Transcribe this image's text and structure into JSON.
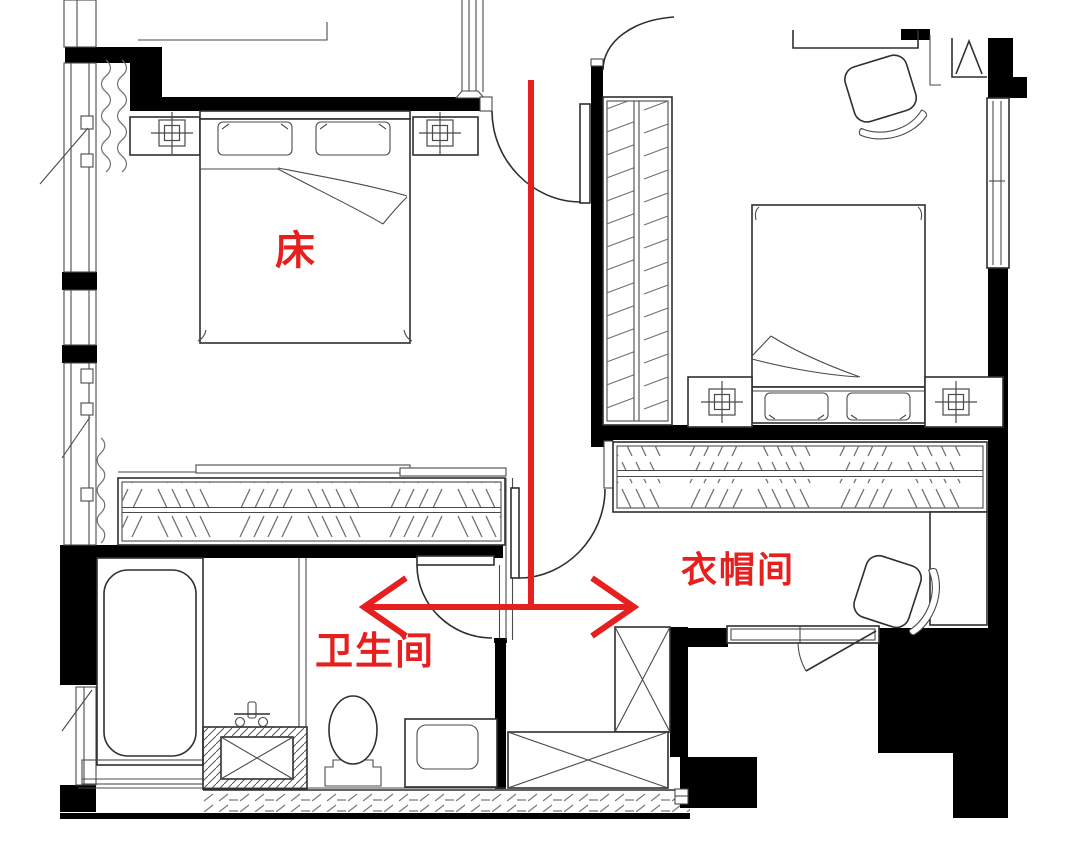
{
  "plan": {
    "type": "apartment-floor-plan",
    "labels": {
      "bed": "床",
      "bathroom": "卫生间",
      "cloakroom": "衣帽间"
    },
    "colors": {
      "annotation": "#e61f1f",
      "wall": "#000000",
      "line": "#2f2f2f",
      "hatch": "#707070",
      "background": "#ffffff"
    }
  }
}
